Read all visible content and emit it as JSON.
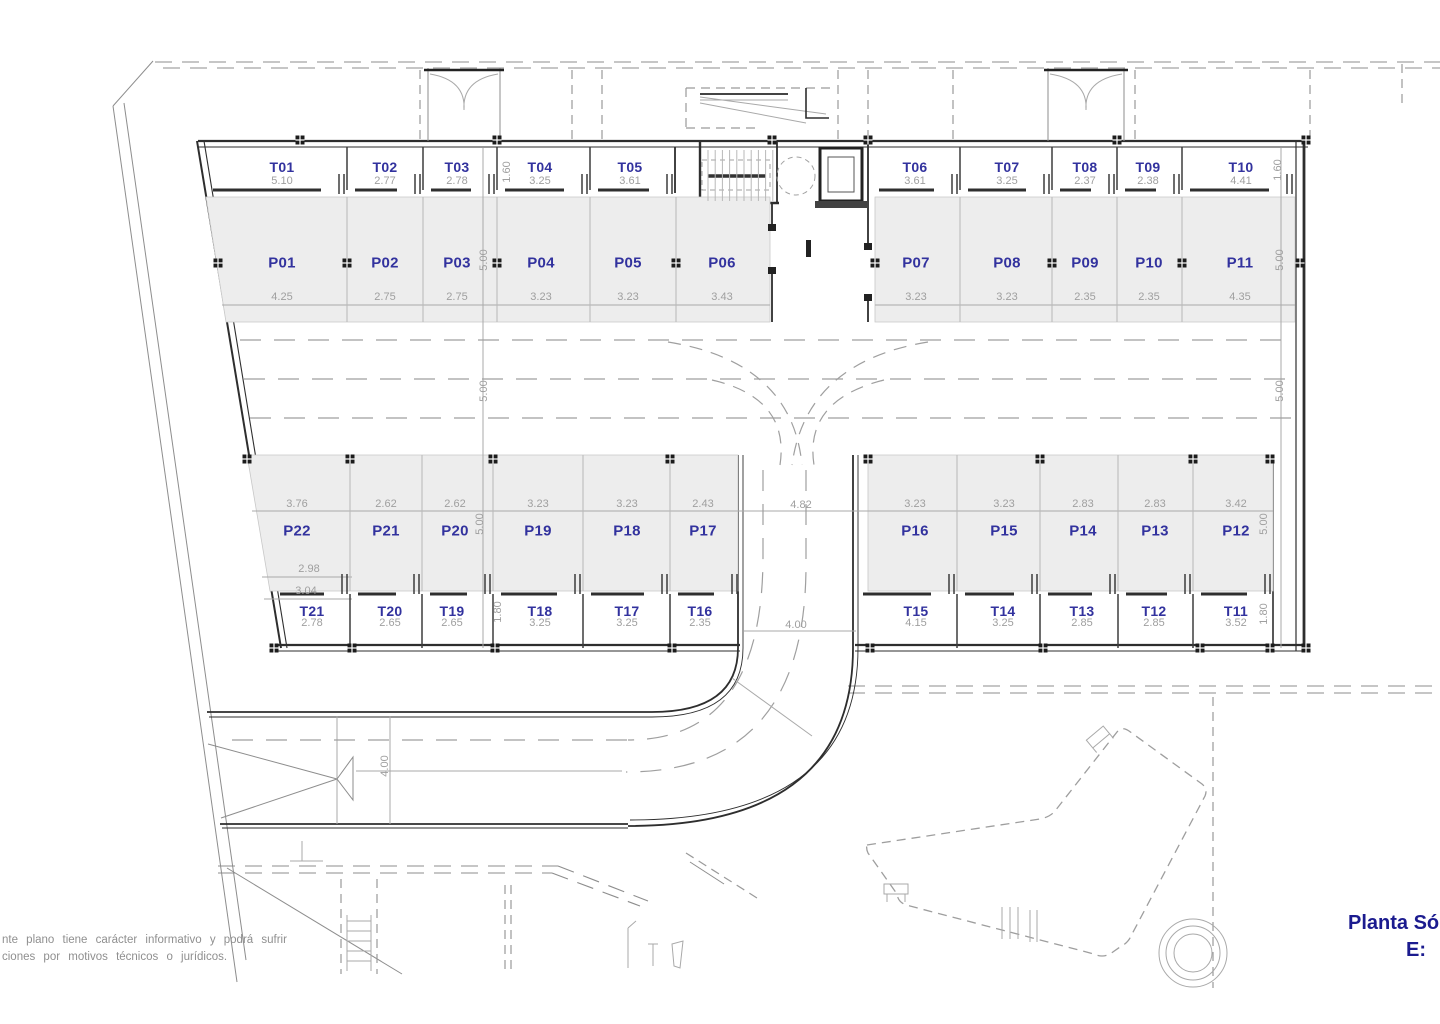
{
  "title_block": {
    "plan_name": "Planta Só",
    "scale_label": "E:"
  },
  "disclaimer": {
    "line1": "nte plano tiene carácter informativo y podrá sufrir",
    "line2": "ciones por motivos técnicos o jurídicos."
  },
  "colors": {
    "label_blue": "#32329e",
    "dim_gray": "#9f9f9f",
    "title_blue": "#1b1b8f",
    "note_gray": "#8f8f8f",
    "stall_fill": "#ededed",
    "wall": "#2e2e2e"
  },
  "plan": {
    "parking_top": [
      {
        "id": "P01",
        "width": "4.25"
      },
      {
        "id": "P02",
        "width": "2.75"
      },
      {
        "id": "P03",
        "width": "2.75"
      },
      {
        "id": "P04",
        "width": "3.23"
      },
      {
        "id": "P05",
        "width": "3.23"
      },
      {
        "id": "P06",
        "width": "3.43"
      },
      {
        "id": "P07",
        "width": "3.23"
      },
      {
        "id": "P08",
        "width": "3.23"
      },
      {
        "id": "P09",
        "width": "2.35"
      },
      {
        "id": "P10",
        "width": "2.35"
      },
      {
        "id": "P11",
        "width": "4.35"
      }
    ],
    "parking_bottom": [
      {
        "id": "P22",
        "width": "3.76"
      },
      {
        "id": "P21",
        "width": "2.62"
      },
      {
        "id": "P20",
        "width": "2.62"
      },
      {
        "id": "P19",
        "width": "3.23"
      },
      {
        "id": "P18",
        "width": "3.23"
      },
      {
        "id": "P17",
        "width": "2.43"
      },
      {
        "id": "P16",
        "width": "3.23"
      },
      {
        "id": "P15",
        "width": "3.23"
      },
      {
        "id": "P14",
        "width": "2.83"
      },
      {
        "id": "P13",
        "width": "2.83"
      },
      {
        "id": "P12",
        "width": "3.42"
      }
    ],
    "storage_top": [
      {
        "id": "T01",
        "width": "5.10"
      },
      {
        "id": "T02",
        "width": "2.77"
      },
      {
        "id": "T03",
        "width": "2.78"
      },
      {
        "id": "T04",
        "width": "3.25"
      },
      {
        "id": "T05",
        "width": "3.61"
      },
      {
        "id": "T06",
        "width": "3.61"
      },
      {
        "id": "T07",
        "width": "3.25"
      },
      {
        "id": "T08",
        "width": "2.37"
      },
      {
        "id": "T09",
        "width": "2.38"
      },
      {
        "id": "T10",
        "width": "4.41"
      }
    ],
    "storage_bottom": [
      {
        "id": "T21",
        "width": "2.78"
      },
      {
        "id": "T20",
        "width": "2.65"
      },
      {
        "id": "T19",
        "width": "2.65"
      },
      {
        "id": "T18",
        "width": "3.25"
      },
      {
        "id": "T17",
        "width": "3.25"
      },
      {
        "id": "T16",
        "width": "2.35"
      },
      {
        "id": "T15",
        "width": "4.15"
      },
      {
        "id": "T14",
        "width": "3.25"
      },
      {
        "id": "T13",
        "width": "2.85"
      },
      {
        "id": "T12",
        "width": "2.85"
      },
      {
        "id": "T11",
        "width": "3.52"
      }
    ],
    "dimension_labels": [
      "1.60",
      "5.00",
      "5.00",
      "5.00",
      "1.80",
      "1.60",
      "5.00",
      "5.00",
      "5.00",
      "1.80",
      "4.82",
      "4.00",
      "4.00",
      "2.98",
      "3.04"
    ]
  }
}
